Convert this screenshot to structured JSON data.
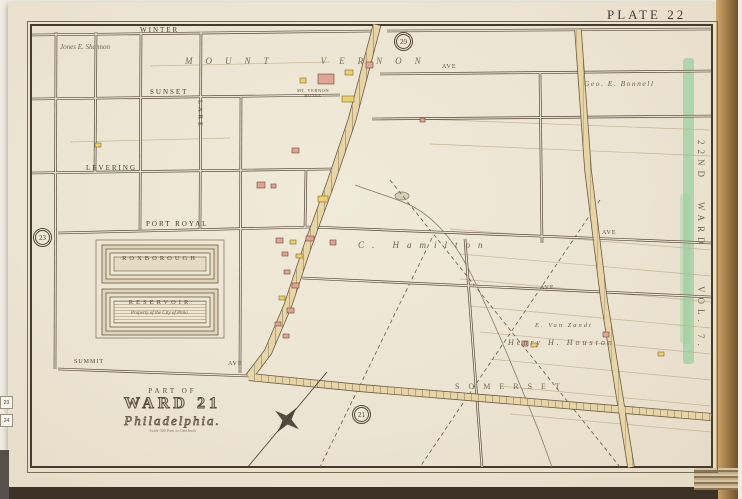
{
  "page": {
    "plate_label": "PLATE 22"
  },
  "margin": {
    "ward_line1": "22ND",
    "ward_line2": "WARD",
    "vol": "VOL. 7.",
    "tab1": "23",
    "tab2": "24"
  },
  "badges": {
    "top": "29",
    "left": "23",
    "bottom": "21"
  },
  "streets": {
    "winter": "WINTER",
    "sunset": "SUNSET",
    "levering": "LEVERING",
    "port_royal": "PORT ROYAL",
    "lare": "LARE",
    "summit": "SUMMIT",
    "ave1": "AVE",
    "ave2": "AVE",
    "ave3": "AVE",
    "ave4": "AVE"
  },
  "owners": {
    "shannon": "Jones E. Shannon",
    "vernon": "MOUNT VERNON",
    "bonnell": "Geo. E. Bonnell",
    "hamilton": "C. Hamilton",
    "vanzandt": "E. Van Zandt",
    "houston": "Henry H. Houston",
    "somerset": "SOMERSET",
    "hotel_line1": "MT. VERNON",
    "hotel_line2": "HOTEL"
  },
  "reservoir": {
    "name1": "ROXBOROUGH",
    "name2": "RESERVOIR",
    "note": "Property of the City of Phila."
  },
  "cartouche": {
    "part_of": "PART OF",
    "ward": "WARD 21",
    "city": "Philadelphia.",
    "scale": "Scale 300 Feet to One Inch"
  },
  "colors": {
    "paper": "#ece4d2",
    "ink": "#463b2c",
    "road_fill": "#e7d5a8",
    "boundary_green": "#9ccf9f",
    "building_brick": "#dfa493",
    "building_frame": "#ecd06e",
    "page_edge_brown": "#9a7444"
  }
}
